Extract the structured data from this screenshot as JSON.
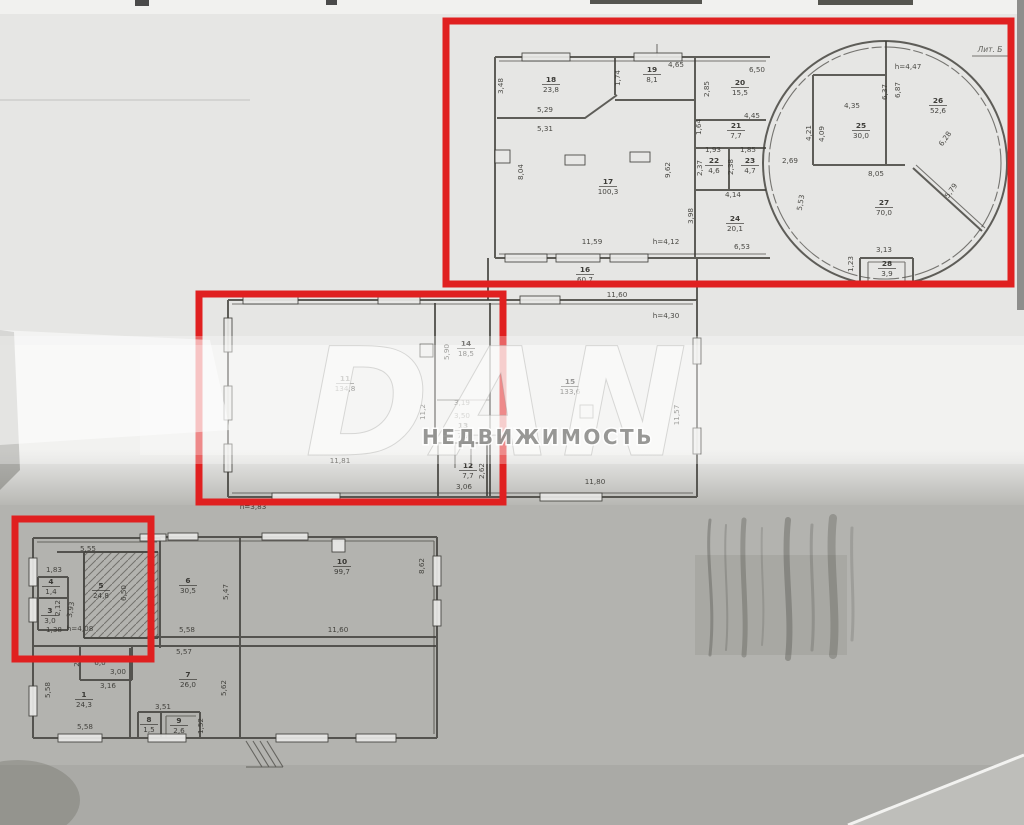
{
  "colors": {
    "red": "#e02020",
    "line": "#3f3e39",
    "paper_light": "#e6e6e4",
    "paper_mid": "#ececea",
    "paper_dark": "#b3b3af"
  },
  "watermark": {
    "word": "DAN",
    "subtitle": "НЕДВИЖИМОСТЬ"
  },
  "annotation": {
    "lit": "Лит. Б"
  },
  "red_boxes": [
    {
      "x": 446,
      "y": 21,
      "w": 565,
      "h": 263
    },
    {
      "x": 199,
      "y": 294,
      "w": 304,
      "h": 208
    },
    {
      "x": 15,
      "y": 519,
      "w": 136,
      "h": 140
    }
  ],
  "rooms": [
    {
      "no": "1",
      "area": "24,3",
      "x": 84,
      "y": 697
    },
    {
      "no": "",
      "area": "6,0",
      "x": 100,
      "y": 655
    },
    {
      "no": "3",
      "area": "3,0",
      "x": 50,
      "y": 613
    },
    {
      "no": "4",
      "area": "1,4",
      "x": 51,
      "y": 584
    },
    {
      "no": "5",
      "area": "24,8",
      "x": 101,
      "y": 588
    },
    {
      "no": "6",
      "area": "30,5",
      "x": 188,
      "y": 583
    },
    {
      "no": "7",
      "area": "26,0",
      "x": 188,
      "y": 677
    },
    {
      "no": "8",
      "area": "1,5",
      "x": 149,
      "y": 722
    },
    {
      "no": "9",
      "area": "2,6",
      "x": 179,
      "y": 723
    },
    {
      "no": "10",
      "area": "99,7",
      "x": 342,
      "y": 564
    },
    {
      "no": "11",
      "area": "134,8",
      "x": 345,
      "y": 381
    },
    {
      "no": "12",
      "area": "7,7",
      "x": 468,
      "y": 468
    },
    {
      "no": "13",
      "area": "7,9",
      "x": 463,
      "y": 428
    },
    {
      "no": "14",
      "area": "18,5",
      "x": 466,
      "y": 346
    },
    {
      "no": "15",
      "area": "133,6",
      "x": 570,
      "y": 384
    },
    {
      "no": "16",
      "area": "60,7",
      "x": 585,
      "y": 272
    },
    {
      "no": "17",
      "area": "100,3",
      "x": 608,
      "y": 184
    },
    {
      "no": "18",
      "area": "23,8",
      "x": 551,
      "y": 82
    },
    {
      "no": "19",
      "area": "8,1",
      "x": 652,
      "y": 72
    },
    {
      "no": "20",
      "area": "15,5",
      "x": 740,
      "y": 85
    },
    {
      "no": "21",
      "area": "7,7",
      "x": 736,
      "y": 128
    },
    {
      "no": "22",
      "area": "4,6",
      "x": 714,
      "y": 163
    },
    {
      "no": "23",
      "area": "4,7",
      "x": 750,
      "y": 163
    },
    {
      "no": "24",
      "area": "20,1",
      "x": 735,
      "y": 221
    },
    {
      "no": "25",
      "area": "30,0",
      "x": 861,
      "y": 128
    },
    {
      "no": "26",
      "area": "52,6",
      "x": 938,
      "y": 103
    },
    {
      "no": "27",
      "area": "70,0",
      "x": 884,
      "y": 205
    },
    {
      "no": "28",
      "area": "3,9",
      "x": 887,
      "y": 266
    }
  ],
  "dims": [
    {
      "t": "3,48",
      "x": 503,
      "y": 86,
      "r": -90
    },
    {
      "t": "5,29",
      "x": 545,
      "y": 112,
      "r": 0
    },
    {
      "t": "5,31",
      "x": 545,
      "y": 131,
      "r": 0
    },
    {
      "t": "1,74",
      "x": 620,
      "y": 78,
      "r": -90
    },
    {
      "t": "4,65",
      "x": 676,
      "y": 67,
      "r": 0
    },
    {
      "t": "2,85",
      "x": 709,
      "y": 89,
      "r": -90
    },
    {
      "t": "6,50",
      "x": 757,
      "y": 72,
      "r": 0
    },
    {
      "t": "1,64",
      "x": 701,
      "y": 127,
      "r": -90
    },
    {
      "t": "4,45",
      "x": 752,
      "y": 118,
      "r": 0
    },
    {
      "t": "1,93",
      "x": 713,
      "y": 152,
      "r": 0
    },
    {
      "t": "2,37",
      "x": 702,
      "y": 168,
      "r": -90
    },
    {
      "t": "1,85",
      "x": 748,
      "y": 152,
      "r": 0
    },
    {
      "t": "2,38",
      "x": 733,
      "y": 167,
      "r": -90
    },
    {
      "t": "4,14",
      "x": 733,
      "y": 197,
      "r": 0
    },
    {
      "t": "3,98",
      "x": 693,
      "y": 216,
      "r": -90
    },
    {
      "t": "6,53",
      "x": 742,
      "y": 249,
      "r": 0
    },
    {
      "t": "8,04",
      "x": 523,
      "y": 172,
      "r": -90
    },
    {
      "t": "9,62",
      "x": 670,
      "y": 170,
      "r": -90
    },
    {
      "t": "11,59",
      "x": 592,
      "y": 244,
      "r": 0
    },
    {
      "t": "h=4,12",
      "x": 666,
      "y": 244,
      "r": 0
    },
    {
      "t": "2,69",
      "x": 790,
      "y": 163,
      "r": 0
    },
    {
      "t": "4,21",
      "x": 811,
      "y": 133,
      "r": -90
    },
    {
      "t": "4,09",
      "x": 824,
      "y": 134,
      "r": -90
    },
    {
      "t": "4,35",
      "x": 852,
      "y": 108,
      "r": 0
    },
    {
      "t": "6,37",
      "x": 887,
      "y": 92,
      "r": -90
    },
    {
      "t": "6,87",
      "x": 900,
      "y": 90,
      "r": -90
    },
    {
      "t": "h=4,47",
      "x": 908,
      "y": 69,
      "r": 0
    },
    {
      "t": "6,28",
      "x": 947,
      "y": 140,
      "r": -55
    },
    {
      "t": "8,05",
      "x": 876,
      "y": 176,
      "r": 0
    },
    {
      "t": "5,53",
      "x": 803,
      "y": 203,
      "r": -80
    },
    {
      "t": "5,79",
      "x": 953,
      "y": 192,
      "r": -55
    },
    {
      "t": "3,13",
      "x": 884,
      "y": 252,
      "r": 0
    },
    {
      "t": "1,23",
      "x": 853,
      "y": 264,
      "r": -90
    },
    {
      "t": "11,60",
      "x": 617,
      "y": 297,
      "r": 0
    },
    {
      "t": "h=4,30",
      "x": 666,
      "y": 318,
      "r": 0
    },
    {
      "t": "5,90",
      "x": 449,
      "y": 352,
      "r": -90
    },
    {
      "t": "11,2",
      "x": 425,
      "y": 412,
      "r": -90
    },
    {
      "t": "3,19",
      "x": 462,
      "y": 405,
      "r": 0
    },
    {
      "t": "3,50",
      "x": 462,
      "y": 418,
      "r": 0
    },
    {
      "t": "2,62",
      "x": 484,
      "y": 471,
      "r": -90
    },
    {
      "t": "3,06",
      "x": 464,
      "y": 489,
      "r": 0
    },
    {
      "t": "11,81",
      "x": 340,
      "y": 463,
      "r": 0
    },
    {
      "t": "11,57",
      "x": 679,
      "y": 415,
      "r": -90
    },
    {
      "t": "11,80",
      "x": 595,
      "y": 484,
      "r": 0
    },
    {
      "t": "h=3,83",
      "x": 253,
      "y": 509,
      "r": 0
    },
    {
      "t": "5,55",
      "x": 88,
      "y": 551,
      "r": 0
    },
    {
      "t": "1,83",
      "x": 54,
      "y": 572,
      "r": 0
    },
    {
      "t": "6,50",
      "x": 126,
      "y": 593,
      "r": -90
    },
    {
      "t": "3,93",
      "x": 73,
      "y": 610,
      "r": -80
    },
    {
      "t": "2,12",
      "x": 60,
      "y": 608,
      "r": -90
    },
    {
      "t": "1,38",
      "x": 54,
      "y": 632,
      "r": 0
    },
    {
      "t": "h=4,08",
      "x": 80,
      "y": 631,
      "r": 0
    },
    {
      "t": "2,1",
      "x": 79,
      "y": 661,
      "r": -90
    },
    {
      "t": "3,00",
      "x": 118,
      "y": 674,
      "r": 0
    },
    {
      "t": "3,16",
      "x": 108,
      "y": 688,
      "r": 0
    },
    {
      "t": "5,58",
      "x": 50,
      "y": 690,
      "r": -90
    },
    {
      "t": "5,58",
      "x": 85,
      "y": 729,
      "r": 0
    },
    {
      "t": "5,47",
      "x": 228,
      "y": 592,
      "r": -90
    },
    {
      "t": "5,58",
      "x": 187,
      "y": 632,
      "r": 0
    },
    {
      "t": "5,57",
      "x": 184,
      "y": 654,
      "r": 0
    },
    {
      "t": "5,62",
      "x": 226,
      "y": 688,
      "r": -90
    },
    {
      "t": "3,51",
      "x": 163,
      "y": 709,
      "r": 0
    },
    {
      "t": "1,52",
      "x": 203,
      "y": 726,
      "r": -90
    },
    {
      "t": "8,62",
      "x": 424,
      "y": 566,
      "r": -90
    },
    {
      "t": "11,60",
      "x": 338,
      "y": 632,
      "r": 0
    }
  ]
}
